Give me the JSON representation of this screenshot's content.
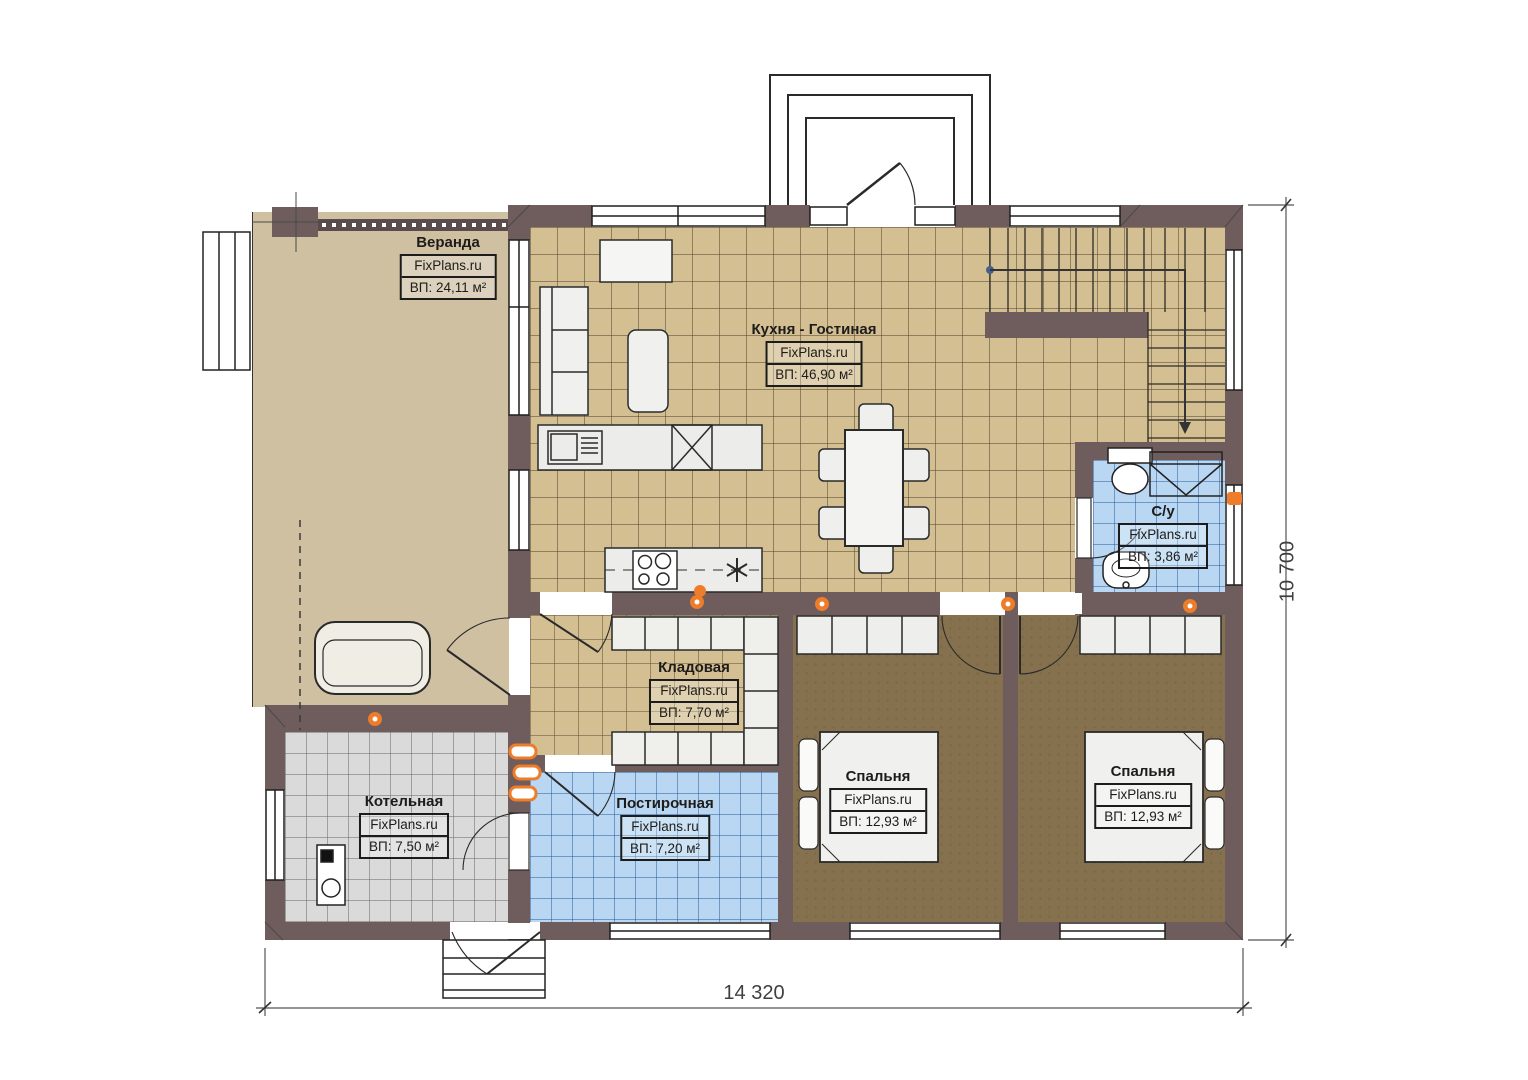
{
  "plan": {
    "title": "Floor plan — first floor",
    "brand": "FixPlans.ru",
    "dimensions": {
      "width_mm": "14 320",
      "height_mm": "10 700"
    },
    "rooms": [
      {
        "id": "veranda",
        "name": "Веранда",
        "brand": "FixPlans.ru",
        "area": "ВП: 24,11 м²"
      },
      {
        "id": "kitchen",
        "name": "Кухня - Гостиная",
        "brand": "FixPlans.ru",
        "area": "ВП:  46,90 м²"
      },
      {
        "id": "wc",
        "name": "С/у",
        "brand": "FixPlans.ru",
        "area": "ВП: 3,86 м²"
      },
      {
        "id": "storage",
        "name": "Кладовая",
        "brand": "FixPlans.ru",
        "area": "ВП: 7,70 м²"
      },
      {
        "id": "boiler",
        "name": "Котельная",
        "brand": "FixPlans.ru",
        "area": "ВП: 7,50 м²"
      },
      {
        "id": "laundry",
        "name": "Постирочная",
        "brand": "FixPlans.ru",
        "area": "ВП: 7,20 м²"
      },
      {
        "id": "bedroom1",
        "name": "Спальня",
        "brand": "FixPlans.ru",
        "area": "ВП: 12,93 м²"
      },
      {
        "id": "bedroom2",
        "name": "Спальня",
        "brand": "FixPlans.ru",
        "area": "ВП: 12,93 м²"
      }
    ],
    "colors": {
      "wall": "#6f5c5c",
      "floor_tan": "#d3bf92",
      "floor_blue": "#b9d7f2",
      "floor_gray": "#dadada",
      "floor_bedroom": "#86714f",
      "floor_veranda": "#cfc0a2",
      "radiator_orange": "#ed7d2b"
    }
  }
}
